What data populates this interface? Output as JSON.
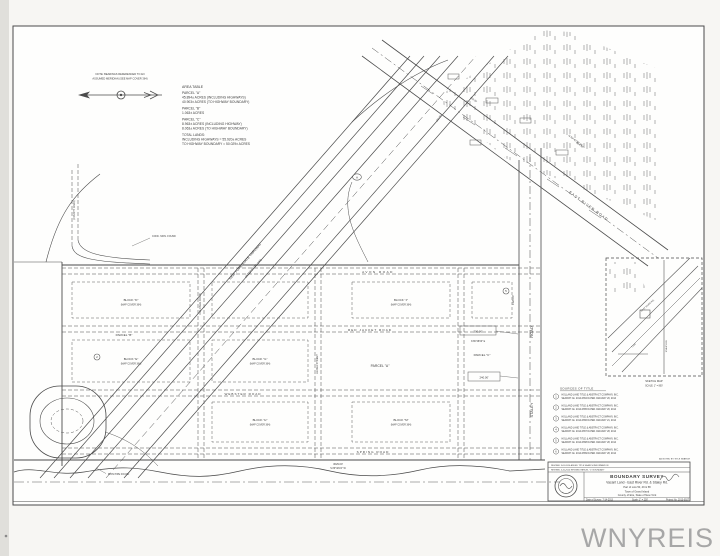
{
  "watermark": "WNYREIS",
  "north": {
    "note1": "NOTE: BEARINGS REFERENCED TO AN",
    "note2": "ASSUMED MERIDIAN (SEE MAP COVER 364)"
  },
  "area_table": {
    "title": "AREA TABLE",
    "lines": [
      "PARCEL \"A\"",
      "45.894± ACRES (INCLUDING HIGHWAYS)",
      "40.903± ACRES (TO HIGHWAY BOUNDARY)",
      "PARCEL \"B\"",
      "1.063± ACRES",
      "PARCEL \"C\"",
      "8.963± ACRES (INCLUDING HIGHWAY)",
      "8.063± ACRES (TO HIGHWAY BOUNDARY)",
      "TOTAL LANDS:",
      "INCLUDING HIGHWAYS = 55.920± ACRES",
      "TO HIGHWAY BOUNDARY = 50.029± ACRES"
    ]
  },
  "roads": {
    "avon": "AVON   ROAD",
    "red_jacket": "RED  JACKET  ROAD",
    "webster": "WEBSTER  ROAD",
    "spring": "SPRING  ROAD",
    "staley_word1": "STALEY",
    "staley_word2": "ROAD",
    "east_river": "EAST  RIVER  ROAD",
    "colonial": "COLONIAL ROAD",
    "aloha": "ALOHA STREET",
    "county": "(COUNTY ROAD)",
    "thruway1": "NEW YORK STATE THRUWAY",
    "thruway2": "(INTERSTATE 190)"
  },
  "parcels": {
    "a": "PARCEL \"A\"",
    "b": "PARCEL \"B\"",
    "c": "PARCEL \"C\""
  },
  "blocks": {
    "d1": "BLOCK \"D\"",
    "d2": "(MAP COVER 364)",
    "e1": "BLOCK \"E\"",
    "e2": "(MAP COVER 364)",
    "g1": "BLOCK \"G\"",
    "g2": "(MAP COVER 364)",
    "h1": "BLOCK \"H\"",
    "h2": "(MAP COVER 364)",
    "j1": "BLOCK \"J\"",
    "j2": "(MAP COVER 364)",
    "m1": "BLOCK \"M\"",
    "m2": "(MAP COVER 364)"
  },
  "dims": {
    "south1": "3629.00'",
    "south2": "S 89°48'24\" W",
    "box300": "300.00'",
    "bear300": "N 89°48'00\" E",
    "box240": "240.00'",
    "err_bear": "N 53°40'30\" W",
    "err_len": "664.58'",
    "tick1": "208.00'",
    "tick2": "150.00'",
    "staley_len": "1320.00'",
    "mon": "CONC. MON. FOUND",
    "pipe": "IRON PIPE FOUND"
  },
  "markers": {
    "m1": "2",
    "m2": "A",
    "m3": "5"
  },
  "sources": {
    "title": "SOURCES OF TITLE",
    "note": "AS NOTED BY TITLE SEARCH",
    "items": [
      {
        "num": "1",
        "line1": "HOLLAND LAND TITLE & ABSTRACT COMPANY, INC.",
        "line2": "SEARCH No. 2014-0654 DATED JANUARY 20, 2014"
      },
      {
        "num": "2",
        "line1": "HOLLAND LAND TITLE & ABSTRACT COMPANY, INC.",
        "line2": "SEARCH No. 2014-0655 DATED JANUARY 20, 2014"
      },
      {
        "num": "3",
        "line1": "HOLLAND LAND TITLE & ABSTRACT COMPANY, INC.",
        "line2": "SEARCH No. 2014-0656 DATED JANUARY 21, 2014"
      },
      {
        "num": "4",
        "line1": "HOLLAND LAND TITLE & ABSTRACT COMPANY, INC.",
        "line2": "SEARCH No. 2014-0657 DATED JANUARY 28, 2014"
      },
      {
        "num": "5",
        "line1": "HOLLAND LAND TITLE & ABSTRACT COMPANY, INC.",
        "line2": "SEARCH No. 2014-0658 DATED JANUARY 28, 2014"
      },
      {
        "num": "6",
        "line1": "HOLLAND LAND TITLE & ABSTRACT COMPANY, INC.",
        "line2": "SEARCH No. 2014-0659 DATED JANUARY 28, 2014"
      }
    ]
  },
  "inset": {
    "cap1": "SKETCH MAP",
    "cap2": "SCALE: 1\" = 800'",
    "lbl1": "EAST RIVER RD.",
    "lbl2": "STALEY RD.",
    "lbl3": "I-190"
  },
  "title_block": {
    "rev1": "REVISED 3-05-2014  ADDED TITLE SEARCH INFORMATION",
    "rev2": "REVISED 4-10-2014  REVISED PARCEL \"C\" BOUNDARY",
    "title": "BOUNDARY SURVEY",
    "subtitle": "Vacant Land - East River Rd. & Staley Rd.",
    "lots": "Part of Lots 50, 49 & 58",
    "town": "Town of Grand Island",
    "county": "County of Erie, State of New York",
    "date": "Date of Survey: 7-14-2013",
    "scale": "Scale: 1\" = 200'",
    "project": "Project No. 2013-0927"
  }
}
